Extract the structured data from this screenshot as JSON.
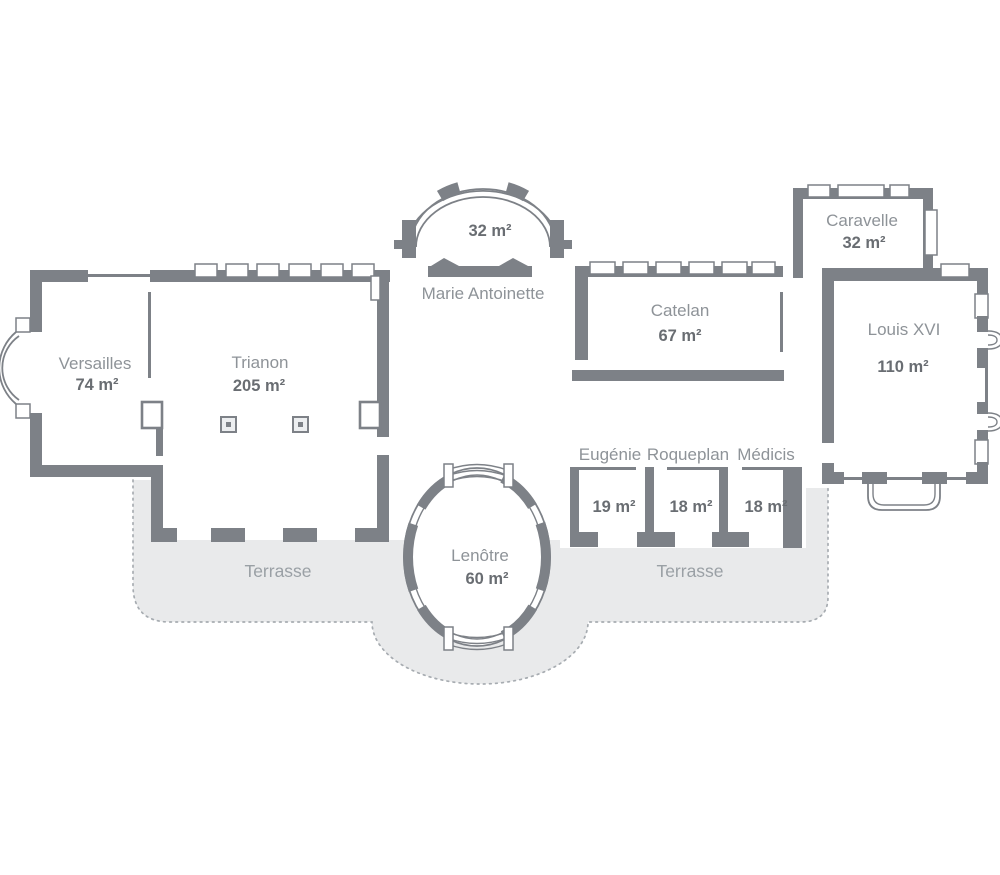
{
  "plan": {
    "rooms": [
      {
        "id": "versailles",
        "name": "Versailles",
        "area": "74 m²"
      },
      {
        "id": "trianon",
        "name": "Trianon",
        "area": "205 m²"
      },
      {
        "id": "marie-antoinette",
        "name": "Marie Antoinette",
        "area": "32 m²"
      },
      {
        "id": "catelan",
        "name": "Catelan",
        "area": "67 m²"
      },
      {
        "id": "caravelle",
        "name": "Caravelle",
        "area": "32 m²"
      },
      {
        "id": "louis-xvi",
        "name": "Louis XVI",
        "area": "110 m²"
      },
      {
        "id": "eugenie",
        "name": "Eugénie",
        "area": "19 m²"
      },
      {
        "id": "roqueplan",
        "name": "Roqueplan",
        "area": "18 m²"
      },
      {
        "id": "medicis",
        "name": "Médicis",
        "area": "18 m²"
      },
      {
        "id": "lenotre",
        "name": "Lenôtre",
        "area": "60 m²"
      }
    ],
    "terraces": [
      {
        "label": "Terrasse"
      },
      {
        "label": "Terrasse"
      }
    ],
    "colors": {
      "background": "#ffffff",
      "wall": "#7d8187",
      "terrace_fill": "#e9eaeb",
      "dotted_border": "#a7acb1",
      "room_name_text": "#8e9398",
      "area_text": "#696d72",
      "terrace_text": "#9aa0a5"
    }
  }
}
